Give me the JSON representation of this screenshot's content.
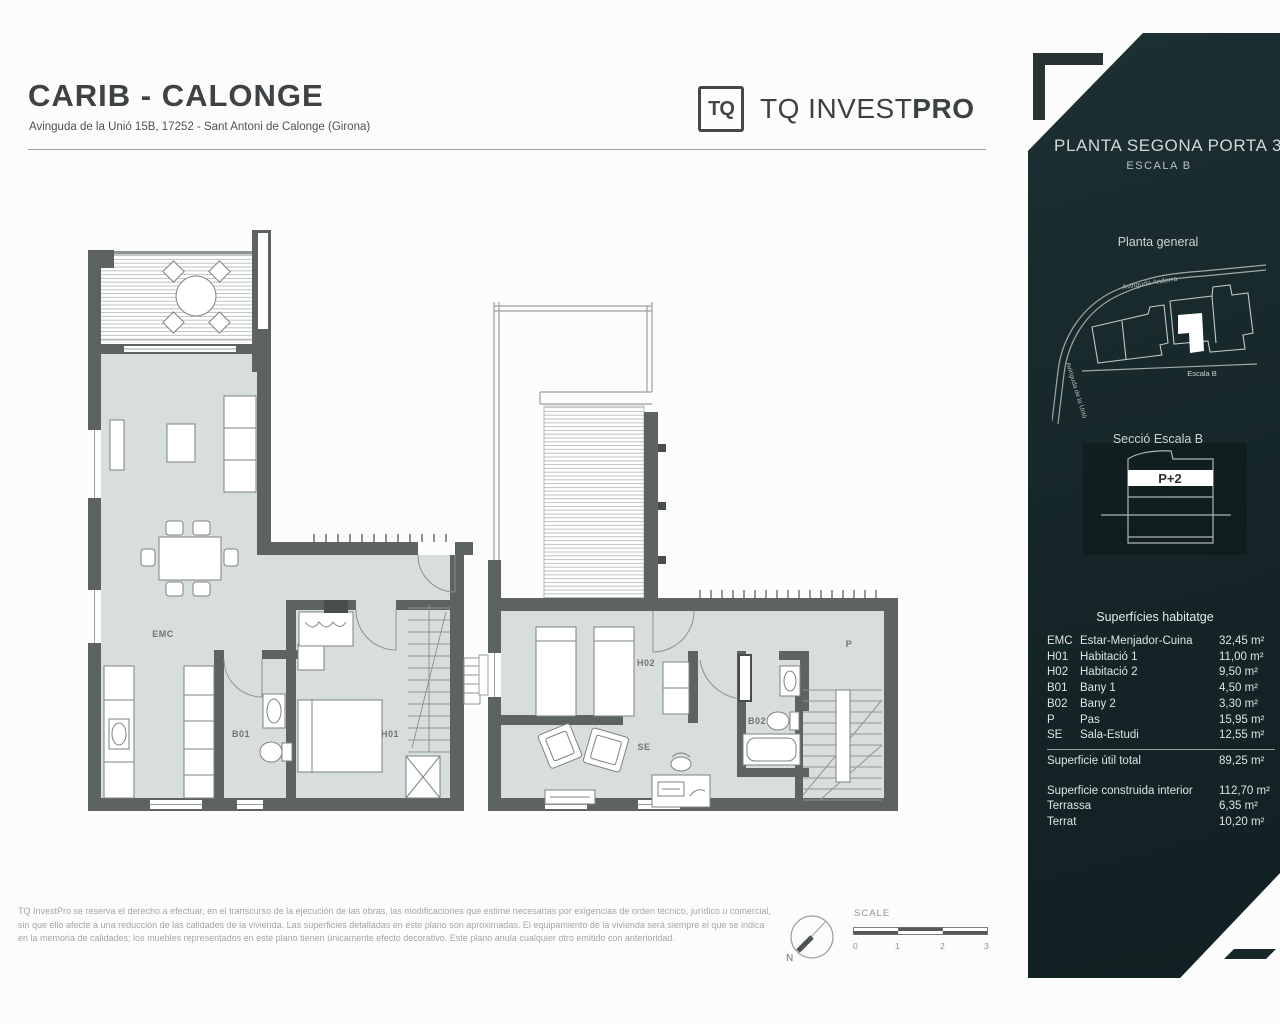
{
  "header": {
    "title": "CARIB - CALONGE",
    "subtitle": "Avinguda de la Unió 15B, 17252 - Sant Antoni de Calonge (Girona)"
  },
  "logo": {
    "mark": "TQ",
    "name": "TQ INVEST",
    "name_bold": "PRO"
  },
  "plans": {
    "left": {
      "emc": "EMC",
      "b01": "B01",
      "h01": "H01"
    },
    "right": {
      "h02": "H02",
      "se": "SE",
      "b02": "B02",
      "p": "P"
    }
  },
  "sidebar": {
    "bg_color": "#17282b",
    "title": "PLANTA SEGONA PORTA 3",
    "subtitle": "ESCALA B",
    "site_plan": {
      "label": "Planta general",
      "street_top": "Avinguda Andorra",
      "street_left": "Avinguda de la Unió",
      "caption": "Escala B"
    },
    "section": {
      "label": "Secció Escala B",
      "floor_tag": "P+2"
    },
    "surfaces": {
      "heading": "Superfícies habitatge",
      "rows": [
        {
          "code": "EMC",
          "name": "Estar-Menjador-Cuina",
          "value": "32,45 m²"
        },
        {
          "code": "H01",
          "name": "Habitació 1",
          "value": "11,00 m²"
        },
        {
          "code": "H02",
          "name": "Habitació 2",
          "value": "9,50 m²"
        },
        {
          "code": "B01",
          "name": "Bany 1",
          "value": "4,50 m²"
        },
        {
          "code": "B02",
          "name": "Bany 2",
          "value": "3,30 m²"
        },
        {
          "code": "P",
          "name": "Pas",
          "value": "15,95 m²"
        },
        {
          "code": "SE",
          "name": "Sala-Estudi",
          "value": "12,55 m²"
        }
      ],
      "total": {
        "name": "Superficie útil total",
        "value": "89,25 m²"
      },
      "extras": [
        {
          "name": "Superficie construida interior",
          "value": "112,70 m²"
        },
        {
          "name": "Terrassa",
          "value": "6,35 m²"
        },
        {
          "name": "Terrat",
          "value": "10,20 m²"
        }
      ]
    }
  },
  "footer": {
    "disclaimer_lines": [
      "TQ InvestPro se reserva el derecho a efectuar, en el transcurso de la ejecución de las obras, las modificaciones que estime necesarias por exigencias de orden técnico, jurídico u comercial,",
      "sin que ello afecte a una reducción de las calidades de la vivienda. Las superficies detalladas en este plano son aproximadas. El equipamiento de la vivienda será siempre el que se indica",
      "en la memoria de calidades; los muebles representados en este plano tienen únicamente efecto decorativo. Este plano anula cualquier otro emitido con anterioridad."
    ],
    "compass_label": "N",
    "scale": {
      "label": "SCALE",
      "ticks": [
        "0",
        "1",
        "2",
        "3"
      ]
    }
  }
}
